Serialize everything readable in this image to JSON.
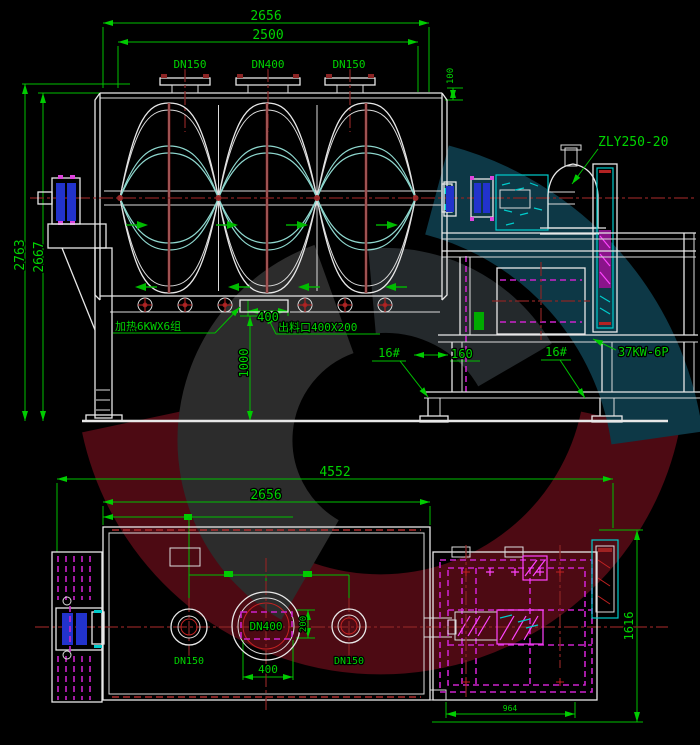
{
  "colors": {
    "background": "#000000",
    "annotation_green": "#00cc00",
    "drawing_white": "#e8e8e8",
    "centerline_red": "#8b2424",
    "bright_red": "#c22222",
    "hatch_magenta": "#cc22cc",
    "detail_cyan": "#00cccc",
    "bearing_blue": "#2233cc",
    "watermark_red": "#4d0a13",
    "watermark_teal": "#0d3846",
    "watermark_gray": "#2c2c2c"
  },
  "front_view": {
    "dim_overall_length": "2656",
    "dim_inner_length": "2500",
    "nozzle_left": "DN150",
    "nozzle_center": "DN400",
    "nozzle_right": "DN150",
    "dim_right_detail": "100",
    "dim_total_height": "2763",
    "dim_shell_height": "2667",
    "label_heater": "加热6KWX6组",
    "label_discharge": "出料口400X200",
    "dim_discharge_width": "400",
    "dim_discharge_height": "1000",
    "label_channel_left": "16#",
    "dim_column_width": "160",
    "label_channel_right": "16#",
    "label_reducer": "ZLY250-20",
    "label_motor": "37KW-6P"
  },
  "plan_view": {
    "dim_overall_length": "4552",
    "dim_vessel_length": "2656",
    "port_left": "DN150",
    "port_center": "DN400",
    "port_right": "DN150",
    "dim_port_spacing": "400",
    "dim_port_offset": "200",
    "dim_platform_width": "1616",
    "dim_platform_length": "964"
  }
}
